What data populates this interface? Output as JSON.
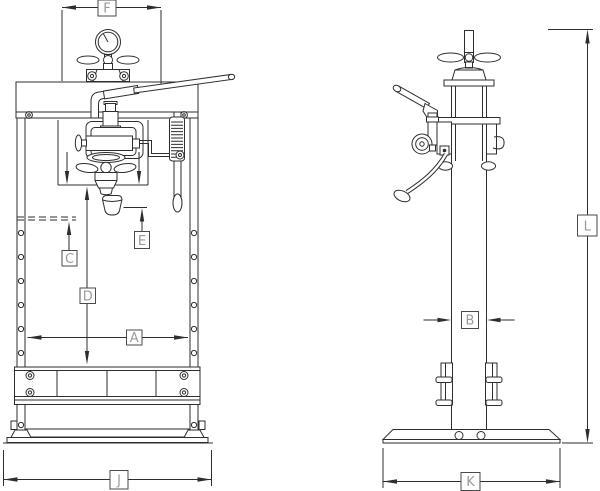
{
  "document": {
    "type": "engineering-drawing",
    "subject": "hydraulic shop press - front and side orthographic views with dimension callouts",
    "background_color": "#ffffff",
    "line_color": "#2e2e2e",
    "label_text_color": "#9a9a9a",
    "label_box_border_color": "#4a4a4a"
  },
  "views": {
    "front": {
      "id": "front-view",
      "dimension_labels": [
        "F",
        "C",
        "D",
        "E",
        "A",
        "J"
      ]
    },
    "side": {
      "id": "side-view",
      "dimension_labels": [
        "B",
        "K",
        "L"
      ]
    }
  },
  "labels": {
    "F": "F",
    "C": "C",
    "D": "D",
    "E": "E",
    "A": "A",
    "J": "J",
    "B": "B",
    "K": "K",
    "L": "L"
  }
}
